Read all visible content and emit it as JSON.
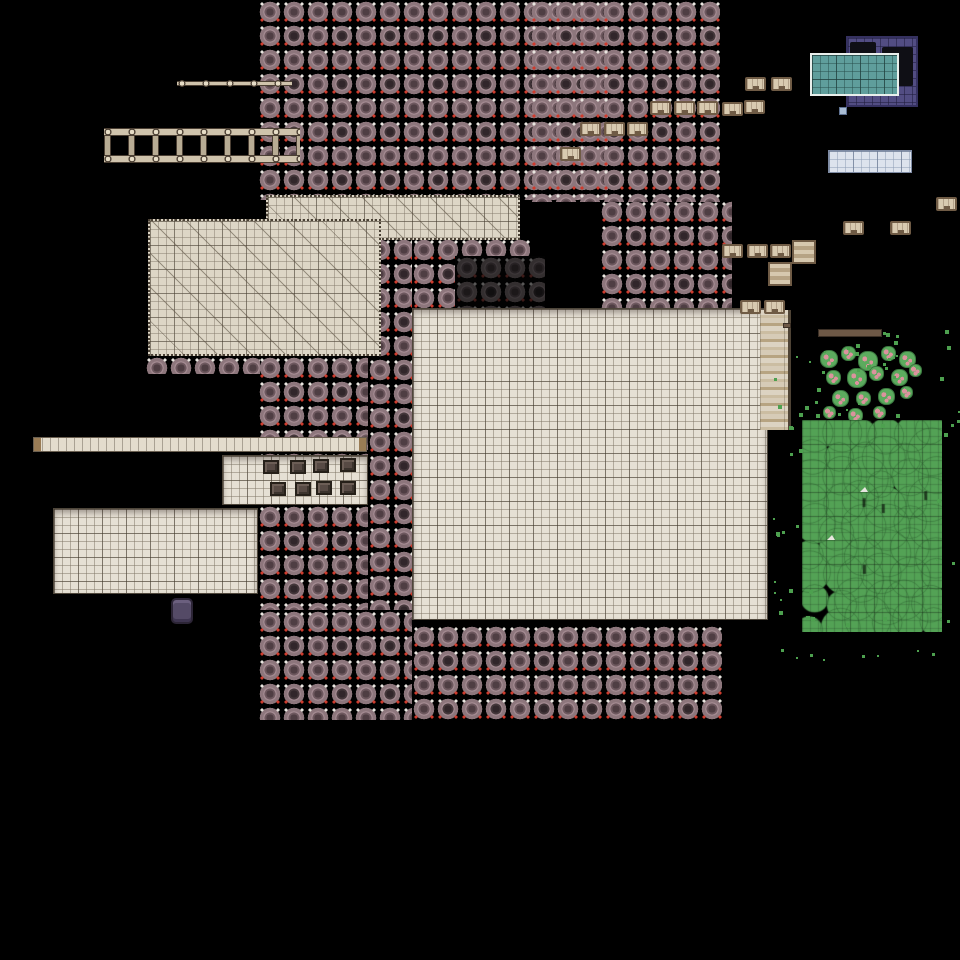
{
  "meta": {
    "scene": "top-down pixel tilemap of a mining colony",
    "background_color": "#000000",
    "tile_size_px": 24,
    "subgrid_px": 8
  },
  "colors": {
    "rock_body": "#8d767c",
    "rock_core": "#4f3e43",
    "rock_rim": "#a38a91",
    "sparkle_red": "#cf3b2d",
    "sparkle_white": "#e9e5df",
    "floor": "#e6e0d4",
    "hatched_floor": "#ddd6c6",
    "wood": "#cfc3ac",
    "crate": "#d8cab0",
    "crate_border": "#6f5b45",
    "pool_water": "#5f9e9c",
    "building_purple": "#524d83",
    "ice": "#dde3ed",
    "tree_green": "#53a255",
    "berry_pink": "#db939d"
  },
  "map": {
    "width": 960,
    "height": 960,
    "rock_regions": [
      {
        "x": 258,
        "y": 0,
        "w": 350,
        "h": 200
      },
      {
        "x": 530,
        "y": 0,
        "w": 190,
        "h": 202
      },
      {
        "x": 600,
        "y": 200,
        "w": 132,
        "h": 112
      },
      {
        "x": 412,
        "y": 238,
        "w": 118,
        "h": 74
      },
      {
        "x": 368,
        "y": 238,
        "w": 44,
        "h": 372
      },
      {
        "x": 145,
        "y": 356,
        "w": 115,
        "h": 18
      },
      {
        "x": 258,
        "y": 356,
        "w": 110,
        "h": 99
      },
      {
        "x": 258,
        "y": 505,
        "w": 110,
        "h": 105
      },
      {
        "x": 258,
        "y": 610,
        "w": 154,
        "h": 110
      },
      {
        "x": 412,
        "y": 625,
        "w": 310,
        "h": 95
      }
    ],
    "dark_patch": {
      "x": 455,
      "y": 256,
      "w": 90,
      "h": 56
    },
    "hatched_floors": [
      {
        "x": 266,
        "y": 195,
        "w": 254,
        "h": 45
      },
      {
        "x": 148,
        "y": 219,
        "w": 233,
        "h": 137
      }
    ],
    "floors": [
      {
        "x": 412,
        "y": 308,
        "w": 356,
        "h": 312
      },
      {
        "x": 53,
        "y": 508,
        "w": 205,
        "h": 86
      },
      {
        "x": 222,
        "y": 455,
        "w": 146,
        "h": 50
      }
    ],
    "plank_strip": {
      "x": 760,
      "y": 310,
      "w": 31,
      "h": 120
    },
    "beam": {
      "x": 33,
      "y": 437,
      "w": 334,
      "h": 15
    },
    "rail": {
      "x": 177,
      "y": 79,
      "w": 115,
      "h": 9
    },
    "ladder": {
      "x": 104,
      "y": 128,
      "w": 196,
      "h": 35
    },
    "building": {
      "x": 846,
      "y": 36,
      "w": 72,
      "h": 71,
      "openings": [
        {
          "x": 850,
          "y": 42,
          "w": 26,
          "h": 14
        },
        {
          "x": 882,
          "y": 47,
          "w": 31,
          "h": 39
        }
      ]
    },
    "pool": {
      "x": 810,
      "y": 53,
      "w": 89,
      "h": 43
    },
    "blue_tile": {
      "x": 839,
      "y": 107,
      "w": 8,
      "h": 8
    },
    "ice": {
      "x": 828,
      "y": 150,
      "w": 84,
      "h": 23
    },
    "brown_bar": {
      "x": 818,
      "y": 329,
      "w": 64,
      "h": 8
    },
    "wood_dash": {
      "x": 783,
      "y": 323,
      "w": 8,
      "h": 5
    },
    "purple_object": {
      "x": 171,
      "y": 598,
      "w": 22,
      "h": 26
    },
    "plank_stacks": [
      [
        792,
        240
      ],
      [
        768,
        262
      ]
    ],
    "crates": [
      [
        745,
        77
      ],
      [
        771,
        77
      ],
      [
        722,
        102
      ],
      [
        744,
        100
      ],
      [
        650,
        101
      ],
      [
        674,
        101
      ],
      [
        697,
        101
      ],
      [
        580,
        122
      ],
      [
        604,
        122
      ],
      [
        627,
        122
      ],
      [
        560,
        147
      ],
      [
        722,
        244
      ],
      [
        747,
        244
      ],
      [
        770,
        244
      ],
      [
        740,
        300
      ],
      [
        764,
        300
      ],
      [
        843,
        221
      ],
      [
        890,
        221
      ],
      [
        936,
        197
      ]
    ],
    "dark_crates": [
      [
        263,
        460
      ],
      [
        290,
        460
      ],
      [
        313,
        459
      ],
      [
        340,
        458
      ],
      [
        270,
        482
      ],
      [
        295,
        482
      ],
      [
        316,
        481
      ],
      [
        340,
        481
      ]
    ],
    "bushes": [
      [
        820,
        350,
        18
      ],
      [
        841,
        346,
        15
      ],
      [
        858,
        351,
        20
      ],
      [
        881,
        346,
        15
      ],
      [
        899,
        351,
        17
      ],
      [
        826,
        370,
        15
      ],
      [
        847,
        368,
        20
      ],
      [
        869,
        366,
        15
      ],
      [
        891,
        369,
        17
      ],
      [
        909,
        364,
        13
      ],
      [
        832,
        390,
        17
      ],
      [
        856,
        391,
        15
      ],
      [
        878,
        388,
        17
      ],
      [
        900,
        386,
        13
      ],
      [
        823,
        406,
        13
      ],
      [
        848,
        408,
        15
      ],
      [
        873,
        406,
        13
      ]
    ],
    "canopy": {
      "x": 802,
      "y": 420,
      "w": 140,
      "h": 212,
      "seed": 11
    },
    "birds": [
      [
        860,
        487
      ],
      [
        827,
        535
      ]
    ],
    "scatter": {
      "x": 770,
      "y": 330,
      "w": 190,
      "h": 330,
      "count": 120,
      "seed": 5,
      "exclude": {
        "x": 810,
        "y": 425,
        "w": 125,
        "h": 190
      }
    }
  }
}
